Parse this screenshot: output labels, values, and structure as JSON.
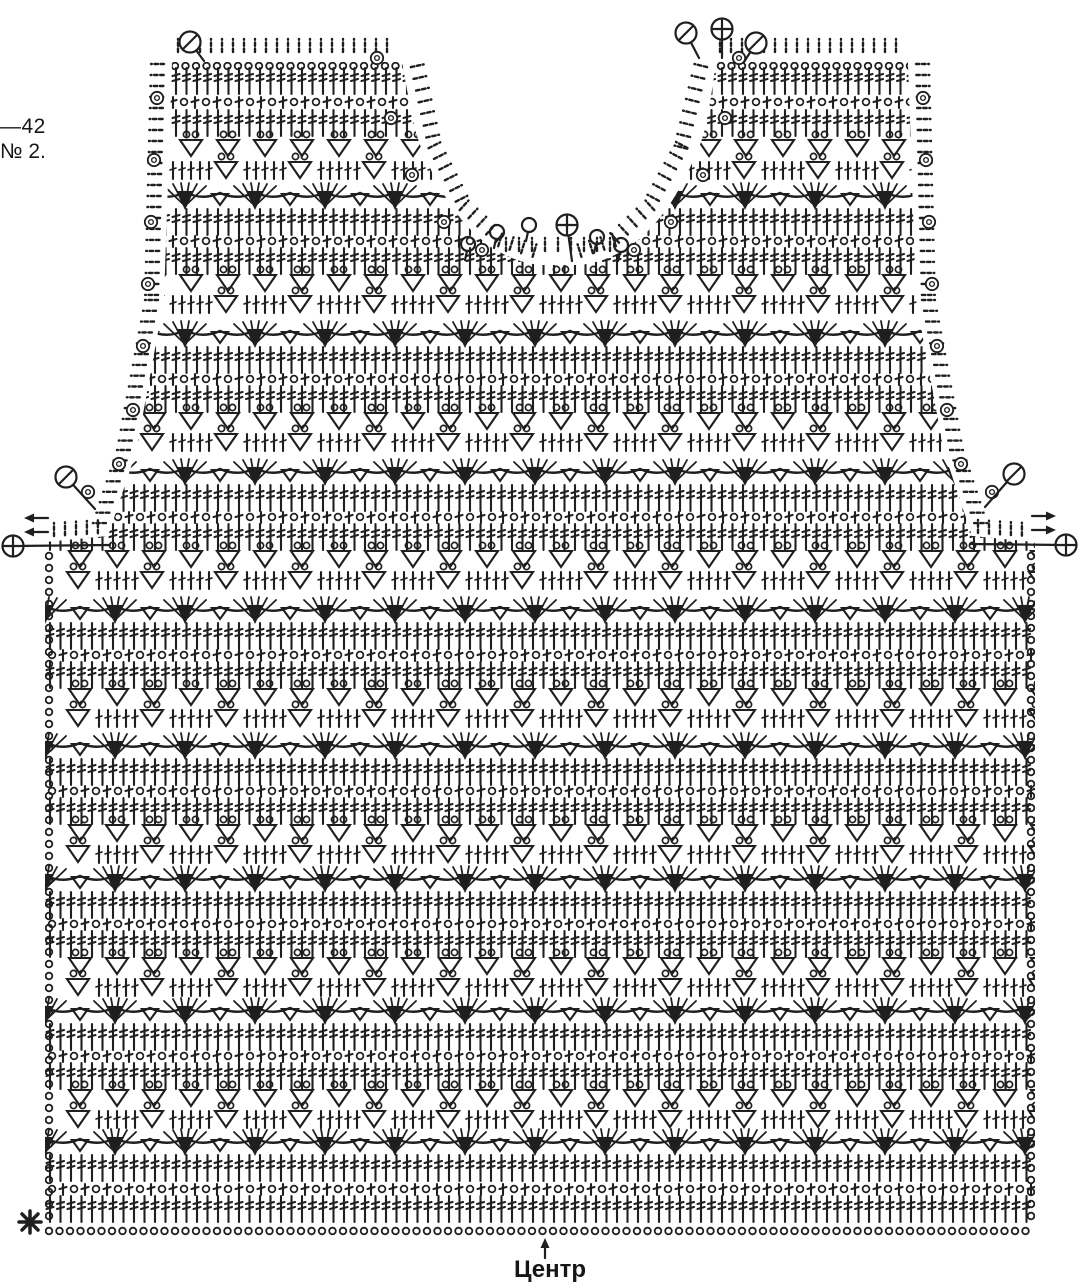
{
  "title_block": {
    "size_label": "—42",
    "pattern_number": "№ 2."
  },
  "footer": {
    "center_label": "Центр",
    "start_marker_name": "asterisk"
  },
  "colors": {
    "ink": "#1f1f1f",
    "background": "#ffffff"
  },
  "legend": {
    "chain": "chain stitch (small circle)",
    "dc": "double-crochet post (bar with cross ticks)",
    "eyelet": "chain + post mesh row",
    "triangle_cluster": "cluster triangle with two chain loops",
    "fan": "shell fan of double crochets over solid cluster wedge",
    "slashed_circle_marker": "fasten-off marker",
    "plus_circle_marker": "join / attach marker",
    "ring_marker": "picot ring on edging",
    "arrows": "work-direction arrows",
    "center_arrow": "center line of the panel"
  },
  "diagram": {
    "canvas": {
      "w": 1080,
      "h": 1288
    },
    "ink": "#1f1f1f",
    "fabric_path": "M172,62 L402,62 C410,105 414,134 424,154 C438,188 454,214 476,235 C495,252 517,263 541,265 L579,265 C603,263 625,252 644,235 C666,214 682,188 696,154 C706,134 710,105 716,62 L908,62 L916,300 L944,452 L972,536 L1035,542 L1035,1236 L45,1236 L45,542 L108,536 L136,452 L164,300 Z",
    "row_span": {
      "x0": 46,
      "x1": 1034
    },
    "rows": [
      {
        "t": "chain",
        "y": 62
      },
      {
        "t": "dc",
        "y": 68
      },
      {
        "t": "eye",
        "y": 96
      },
      {
        "t": "dc",
        "y": 110
      },
      {
        "t": "tri",
        "y": 140
      },
      {
        "t": "tridc",
        "y": 162
      },
      {
        "t": "fan",
        "y": 185
      },
      {
        "t": "dc",
        "y": 209
      },
      {
        "t": "eye",
        "y": 235
      },
      {
        "t": "dc",
        "y": 248
      },
      {
        "t": "tri",
        "y": 275
      },
      {
        "t": "tridc",
        "y": 296
      },
      {
        "t": "fan",
        "y": 323
      },
      {
        "t": "dc",
        "y": 347
      },
      {
        "t": "eye",
        "y": 373
      },
      {
        "t": "dc",
        "y": 386
      },
      {
        "t": "tri",
        "y": 413
      },
      {
        "t": "tridc",
        "y": 434
      },
      {
        "t": "fan",
        "y": 461
      },
      {
        "t": "dc",
        "y": 485
      },
      {
        "t": "eye",
        "y": 511
      },
      {
        "t": "dc",
        "y": 524
      },
      {
        "t": "tri",
        "y": 551
      },
      {
        "t": "tridc",
        "y": 572
      },
      {
        "t": "fan",
        "y": 599
      },
      {
        "t": "dc",
        "y": 623
      },
      {
        "t": "eye",
        "y": 649
      },
      {
        "t": "dc",
        "y": 662
      },
      {
        "t": "tri",
        "y": 689
      },
      {
        "t": "tridc",
        "y": 710
      },
      {
        "t": "fan",
        "y": 735
      },
      {
        "t": "dc",
        "y": 759
      },
      {
        "t": "eye",
        "y": 785
      },
      {
        "t": "dc",
        "y": 798
      },
      {
        "t": "tri",
        "y": 825
      },
      {
        "t": "tridc",
        "y": 846
      },
      {
        "t": "fan",
        "y": 868
      },
      {
        "t": "dc",
        "y": 892
      },
      {
        "t": "eye",
        "y": 918
      },
      {
        "t": "dc",
        "y": 931
      },
      {
        "t": "tri",
        "y": 958
      },
      {
        "t": "tridc",
        "y": 979
      },
      {
        "t": "fan",
        "y": 1000
      },
      {
        "t": "dc",
        "y": 1024
      },
      {
        "t": "eye",
        "y": 1050
      },
      {
        "t": "dc",
        "y": 1063
      },
      {
        "t": "tri",
        "y": 1090
      },
      {
        "t": "tridc",
        "y": 1111
      },
      {
        "t": "fan",
        "y": 1131
      },
      {
        "t": "dc",
        "y": 1155
      },
      {
        "t": "eye",
        "y": 1183
      },
      {
        "t": "dc",
        "y": 1196
      },
      {
        "t": "chain",
        "y": 1227
      }
    ],
    "edges": [
      {
        "dir": "left",
        "step": 11,
        "pts": [
          [
            168,
            64
          ],
          [
            162,
            300
          ],
          [
            134,
            450
          ],
          [
            107,
            532
          ]
        ]
      },
      {
        "dir": "up",
        "step": 11,
        "pts": [
          [
            54,
            540
          ],
          [
            102,
            537
          ]
        ]
      },
      {
        "dir": "right",
        "step": 11,
        "pts": [
          [
            912,
            64
          ],
          [
            918,
            300
          ],
          [
            946,
            450
          ],
          [
            973,
            532
          ]
        ]
      },
      {
        "dir": "up",
        "step": 11,
        "pts": [
          [
            978,
            537
          ],
          [
            1026,
            540
          ]
        ]
      },
      {
        "dir": "up",
        "step": 11,
        "pts": [
          [
            178,
            56
          ],
          [
            396,
            56
          ]
        ]
      },
      {
        "dir": "up",
        "step": 11,
        "pts": [
          [
            720,
            56
          ],
          [
            902,
            56
          ]
        ]
      },
      {
        "dir": "n-",
        "step": 12,
        "pts": [
          [
            407,
            68
          ],
          [
            425,
            150
          ],
          [
            457,
            213
          ],
          [
            497,
            250
          ],
          [
            536,
            262
          ]
        ]
      },
      {
        "dir": "n+",
        "step": 12,
        "pts": [
          [
            711,
            68
          ],
          [
            691,
            150
          ],
          [
            657,
            213
          ],
          [
            617,
            250
          ],
          [
            578,
            262
          ]
        ]
      },
      {
        "dir": "up",
        "step": 13,
        "pts": [
          [
            506,
            255
          ],
          [
            612,
            255
          ]
        ]
      }
    ],
    "rings": [
      [
        157,
        98
      ],
      [
        154,
        160
      ],
      [
        151,
        222
      ],
      [
        148,
        284
      ],
      [
        143,
        346
      ],
      [
        133,
        410
      ],
      [
        119,
        464
      ],
      [
        88,
        492
      ],
      [
        923,
        98
      ],
      [
        926,
        160
      ],
      [
        929,
        222
      ],
      [
        932,
        284
      ],
      [
        937,
        346
      ],
      [
        947,
        410
      ],
      [
        961,
        464
      ],
      [
        992,
        492
      ],
      [
        377,
        58
      ],
      [
        391,
        118
      ],
      [
        412,
        175
      ],
      [
        444,
        222
      ],
      [
        482,
        250
      ],
      [
        739,
        58
      ],
      [
        725,
        118
      ],
      [
        703,
        175
      ],
      [
        671,
        222
      ],
      [
        634,
        250
      ]
    ],
    "markers": [
      {
        "type": "slashed-circle",
        "x": 190,
        "y": 42,
        "sx": 204,
        "sy": 61
      },
      {
        "type": "slashed-circle",
        "x": 686,
        "y": 33,
        "sx": 699,
        "sy": 58
      },
      {
        "type": "plus-circle",
        "x": 722,
        "y": 29,
        "sx": 722,
        "sy": 58
      },
      {
        "type": "slashed-circle",
        "x": 756,
        "y": 43,
        "sx": 744,
        "sy": 62
      },
      {
        "type": "slashed-circle",
        "x": 66,
        "y": 477,
        "sx": 95,
        "sy": 509
      },
      {
        "type": "slashed-circle",
        "x": 1014,
        "y": 474,
        "sx": 985,
        "sy": 507
      },
      {
        "type": "plus-circle",
        "x": 567,
        "y": 225,
        "sx": 572,
        "sy": 261
      },
      {
        "type": "plus-circle-line",
        "x": 13,
        "y": 546,
        "lx": 110,
        "ly": 545
      },
      {
        "type": "plus-circle-line",
        "x": 1066,
        "y": 545,
        "lx": 970,
        "ly": 544
      },
      {
        "type": "arrow-left",
        "x": 24,
        "y": 518
      },
      {
        "type": "arrow-left",
        "x": 24,
        "y": 532
      },
      {
        "type": "arrow-right",
        "x": 1056,
        "y": 516
      },
      {
        "type": "arrow-right",
        "x": 1056,
        "y": 530
      },
      {
        "type": "arrow-up",
        "x": 545,
        "y": 1238
      },
      {
        "type": "asterisk",
        "x": 30,
        "y": 1222
      }
    ],
    "neck_loops": [
      [
        468,
        251
      ],
      [
        497,
        239
      ],
      [
        529,
        232
      ],
      [
        597,
        244
      ],
      [
        621,
        252
      ]
    ],
    "side_chain_columns": {
      "xs": [
        49,
        1031
      ],
      "y0": 556,
      "y1": 1222,
      "step": 12
    }
  }
}
